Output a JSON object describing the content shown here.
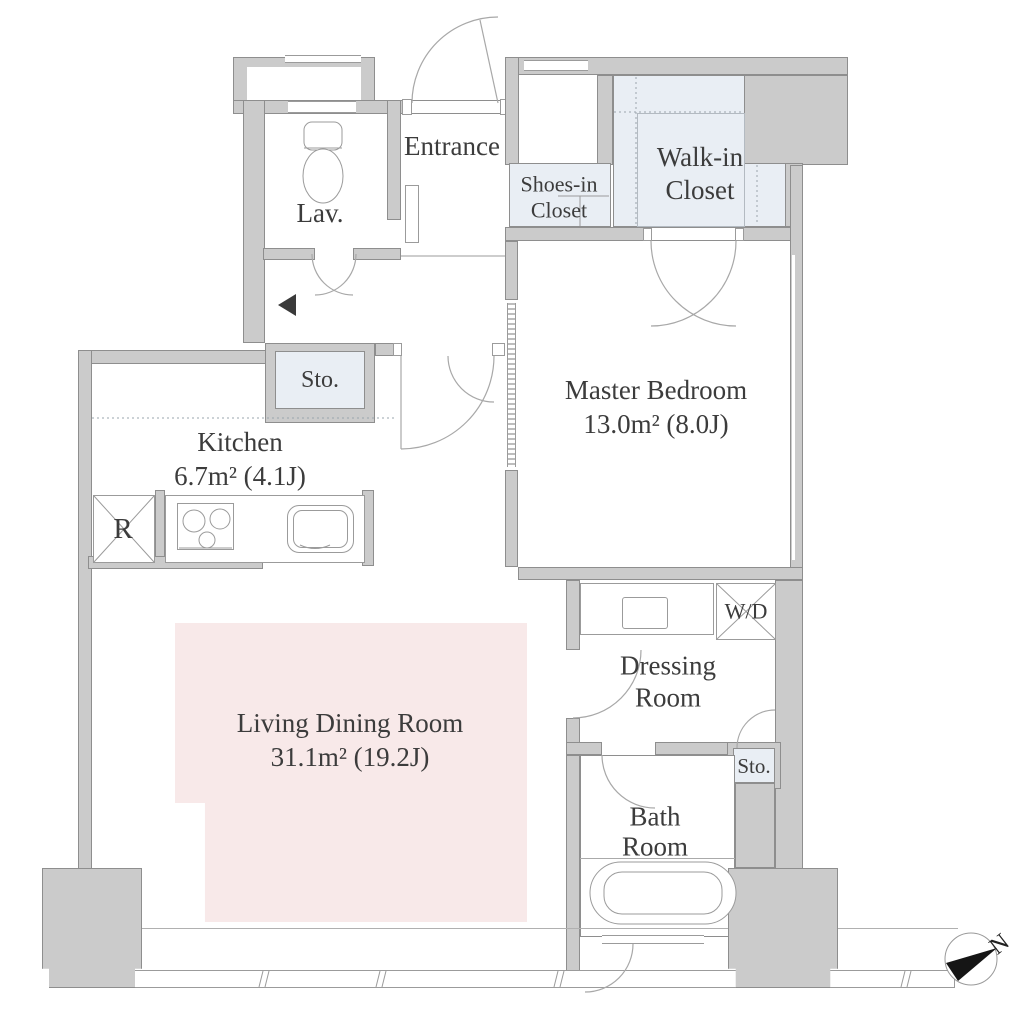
{
  "rooms": {
    "lav": "Lav.",
    "entrance": "Entrance",
    "shoes_closet": {
      "line1": "Shoes-in",
      "line2": "Closet"
    },
    "walkin_closet": {
      "line1": "Walk-in",
      "line2": "Closet"
    },
    "master_bedroom": {
      "name": "Master Bedroom",
      "area": "13.0m² (8.0J)"
    },
    "kitchen": {
      "name": "Kitchen",
      "area": "6.7m² (4.1J)"
    },
    "living_dining": {
      "name": "Living Dining Room",
      "area": "31.1m² (19.2J)"
    },
    "dressing_room": {
      "line1": "Dressing",
      "line2": "Room"
    },
    "bath_room": {
      "line1": "Bath",
      "line2": "Room"
    },
    "storage_hall": "Sto.",
    "storage_dressing": "Sto."
  },
  "fixtures": {
    "washer_dryer": "W/D",
    "refrigerator": "R"
  },
  "compass": {
    "north": "N"
  },
  "colors": {
    "wall": "#cbcbcb",
    "wall_line": "#8e8e8e",
    "closet_fill": "#e9eef4",
    "living_fill": "#f8e9e9",
    "text": "#3c3c3c"
  }
}
